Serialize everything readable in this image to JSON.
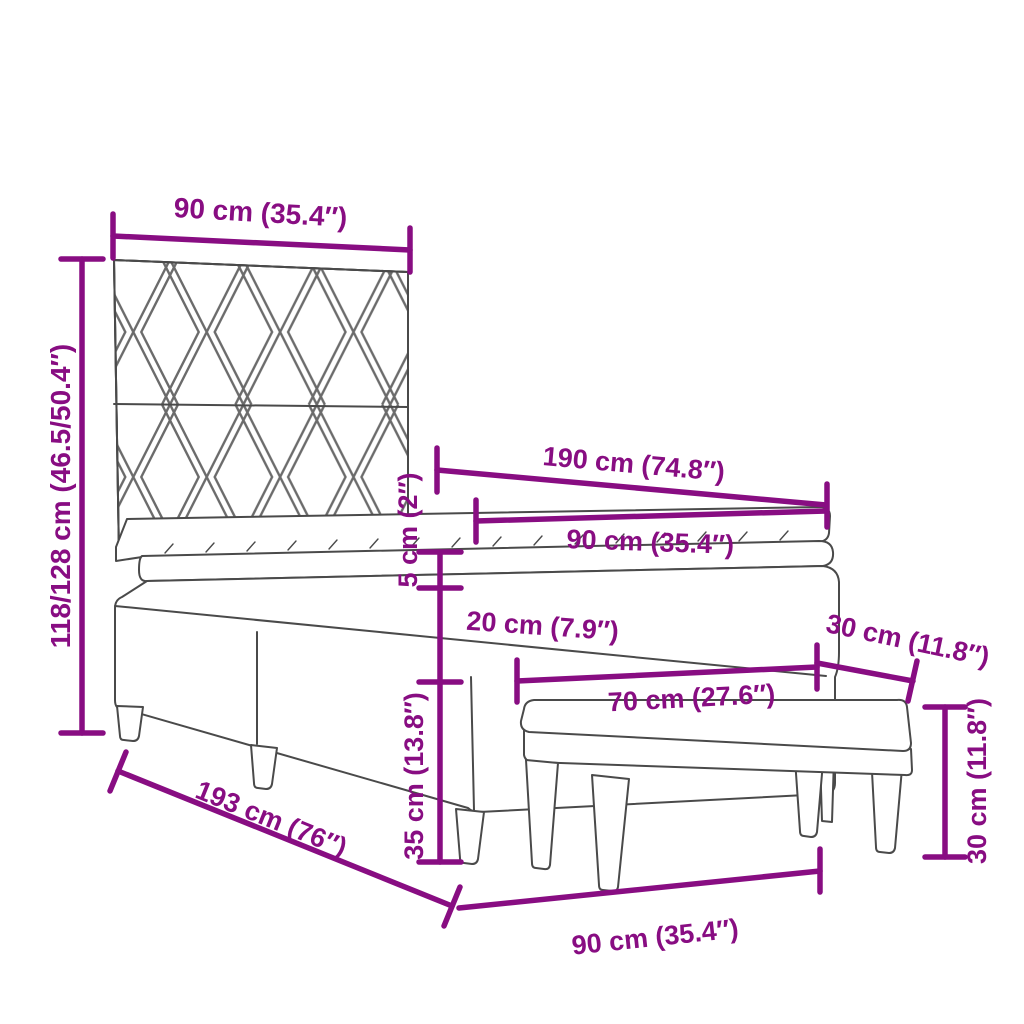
{
  "diagram": {
    "subject": "box-spring-bed-with-headboard-and-bench-dimensions",
    "colors": {
      "dimension": "#880D82",
      "line_art": "#4a4a4a",
      "pattern": "#6b6b6b",
      "background": "#ffffff"
    },
    "dims": {
      "headboard_width": {
        "label": "90 cm (35.4″)"
      },
      "total_height": {
        "label": "118/128 cm (46.5/50.4″)"
      },
      "bed_length": {
        "label": "190 cm (74.8″)"
      },
      "mattress_width": {
        "label": "90 cm (35.4″)"
      },
      "topper_thickness": {
        "label": "5 cm (2″)"
      },
      "mattress_thickness": {
        "label": "20 cm (7.9″)"
      },
      "base_height": {
        "label": "35 cm (13.8″)"
      },
      "bench_length": {
        "label": "70 cm (27.6″)"
      },
      "bench_depth": {
        "label": "30 cm (11.8″)"
      },
      "bench_height": {
        "label": "30 cm (11.8″)"
      },
      "frame_length": {
        "label": "193 cm (76″)"
      },
      "frame_width": {
        "label": "90 cm (35.4″)"
      }
    }
  }
}
